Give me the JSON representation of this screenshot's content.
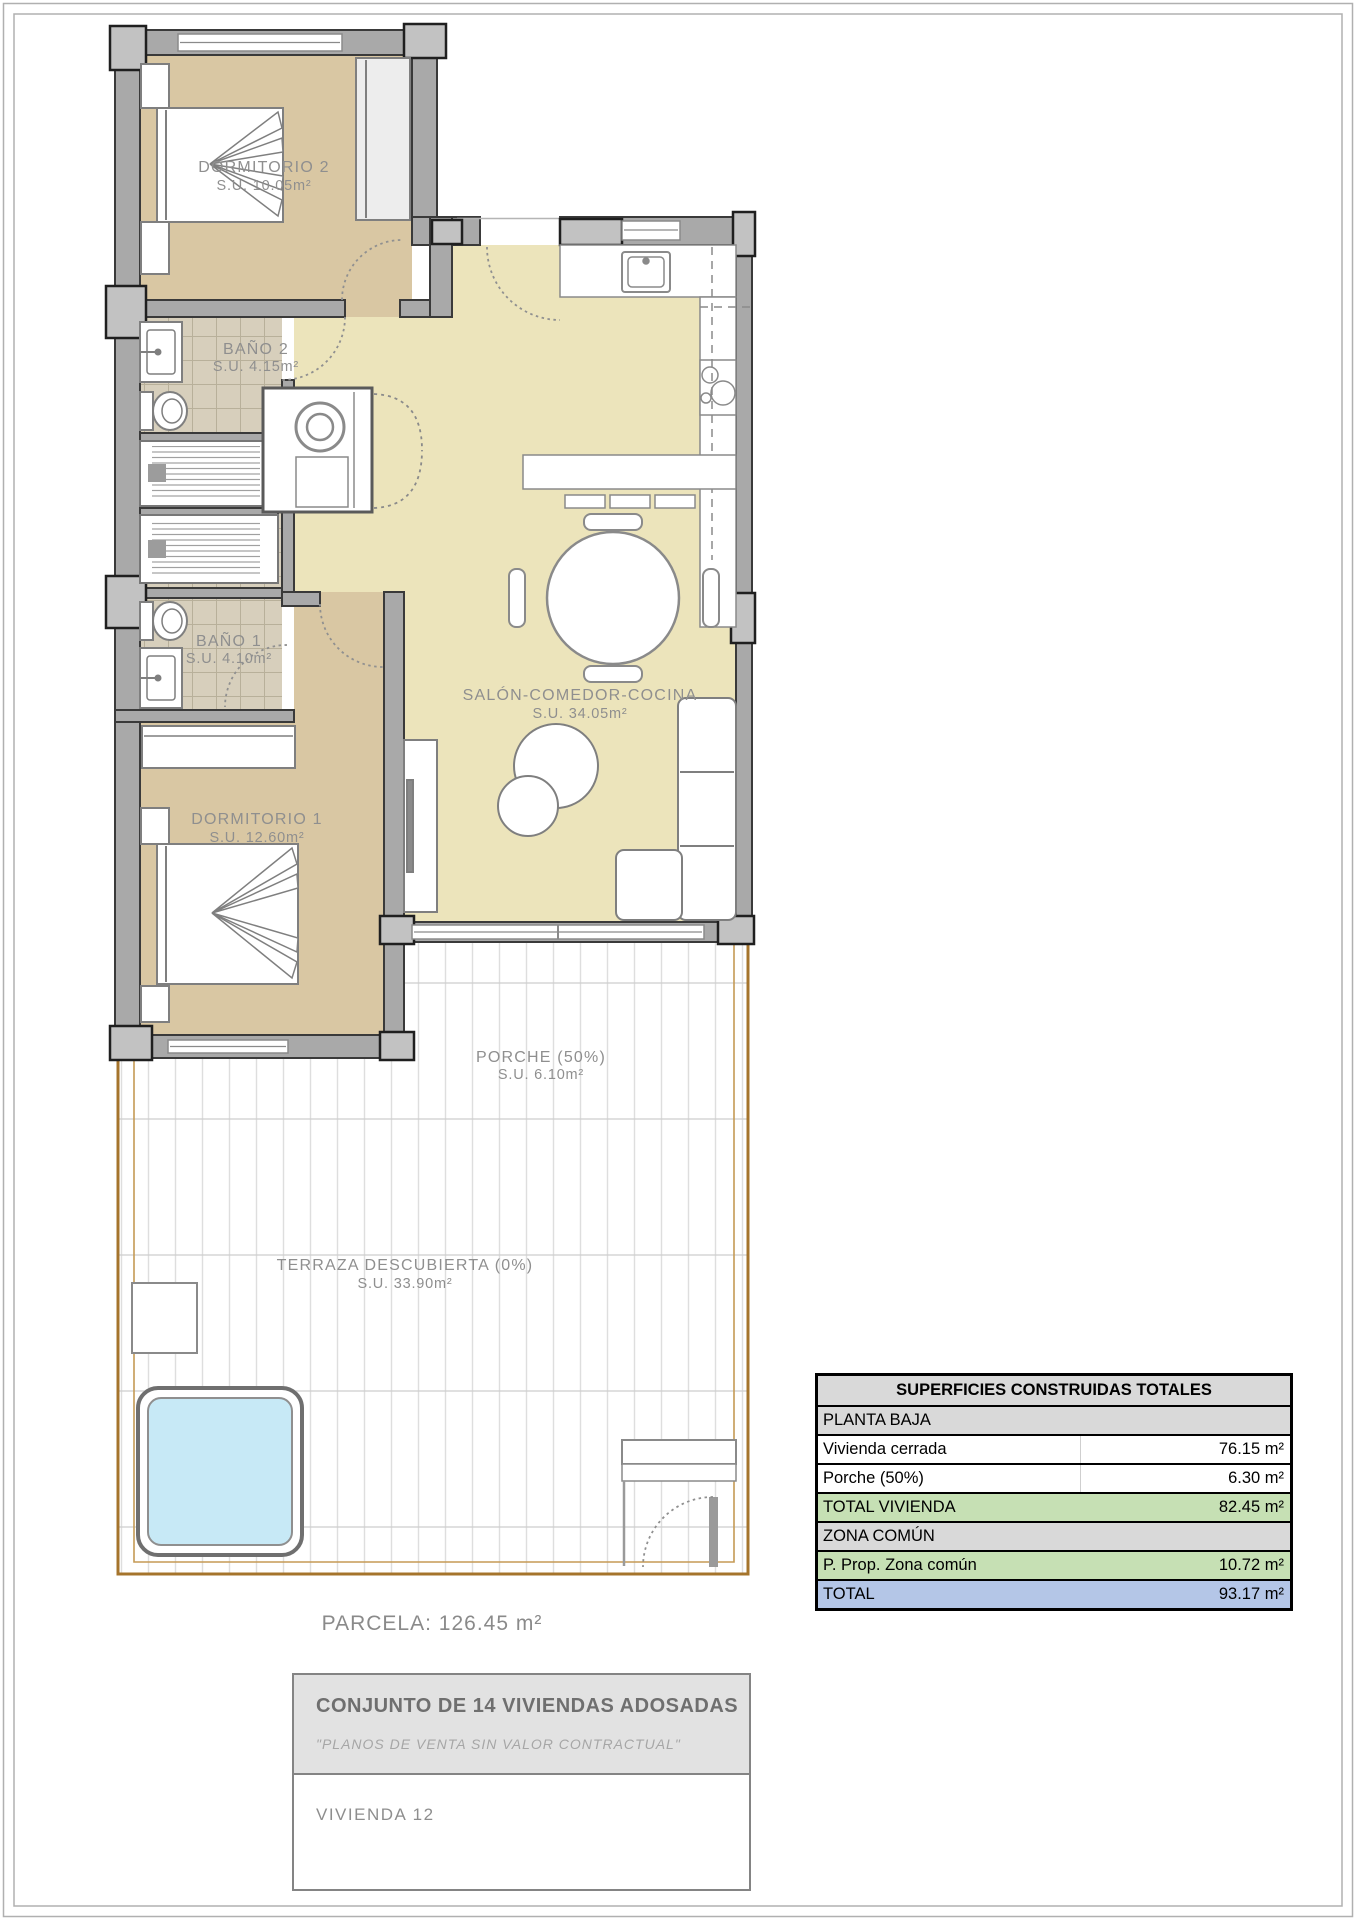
{
  "plan": {
    "rooms": {
      "dormitorio2": {
        "name": "DORMITORIO 2",
        "area": "S.U. 10.05m²"
      },
      "bano2": {
        "name": "BAÑO 2",
        "area": "S.U. 4.15m²"
      },
      "bano1": {
        "name": "BAÑO 1",
        "area": "S.U. 4.10m²"
      },
      "dormitorio1": {
        "name": "DORMITORIO 1",
        "area": "S.U. 12.60m²"
      },
      "salon": {
        "name": "SALÓN-COMEDOR-COCINA",
        "area": "S.U. 34.05m²"
      },
      "porche": {
        "name": "PORCHE (50%)",
        "area": "S.U. 6.10m²"
      },
      "terraza": {
        "name": "TERRAZA DESCUBIERTA (0%)",
        "area": "S.U. 33.90m²"
      }
    },
    "parcela_label": "PARCELA: 126.45 m²",
    "colors": {
      "floor_bedroom": "#d9c7a3",
      "floor_living": "#ece4bb",
      "floor_bath": "#d7cfbc",
      "wall_fill": "#a9a9a9",
      "pool_fill": "#c7e9f6",
      "parcel_boundary": "#a5742c",
      "label_text": "#8f8f8f"
    }
  },
  "summary_table": {
    "title": "SUPERFICIES CONSTRUIDAS TOTALES",
    "rows": [
      {
        "label": "PLANTA BAJA",
        "value": ""
      },
      {
        "label": "Vivienda cerrada",
        "value": "76.15 m²"
      },
      {
        "label": "Porche (50%)",
        "value": "6.30 m²"
      },
      {
        "label": "TOTAL VIVIENDA",
        "value": "82.45 m²"
      },
      {
        "label": "ZONA COMÚN",
        "value": ""
      },
      {
        "label": "P. Prop. Zona común",
        "value": "10.72 m²"
      },
      {
        "label": "TOTAL",
        "value": "93.17 m²"
      }
    ],
    "colors": {
      "section_bg": "#d9d9d9",
      "subtotal_bg": "#c6e0b4",
      "total_bg": "#b4c6e7"
    }
  },
  "title_block": {
    "project_title": "CONJUNTO DE 14 VIVIENDAS ADOSADAS",
    "disclaimer": "\"PLANOS DE VENTA SIN VALOR CONTRACTUAL\"",
    "unit_label": "VIVIENDA 12"
  }
}
